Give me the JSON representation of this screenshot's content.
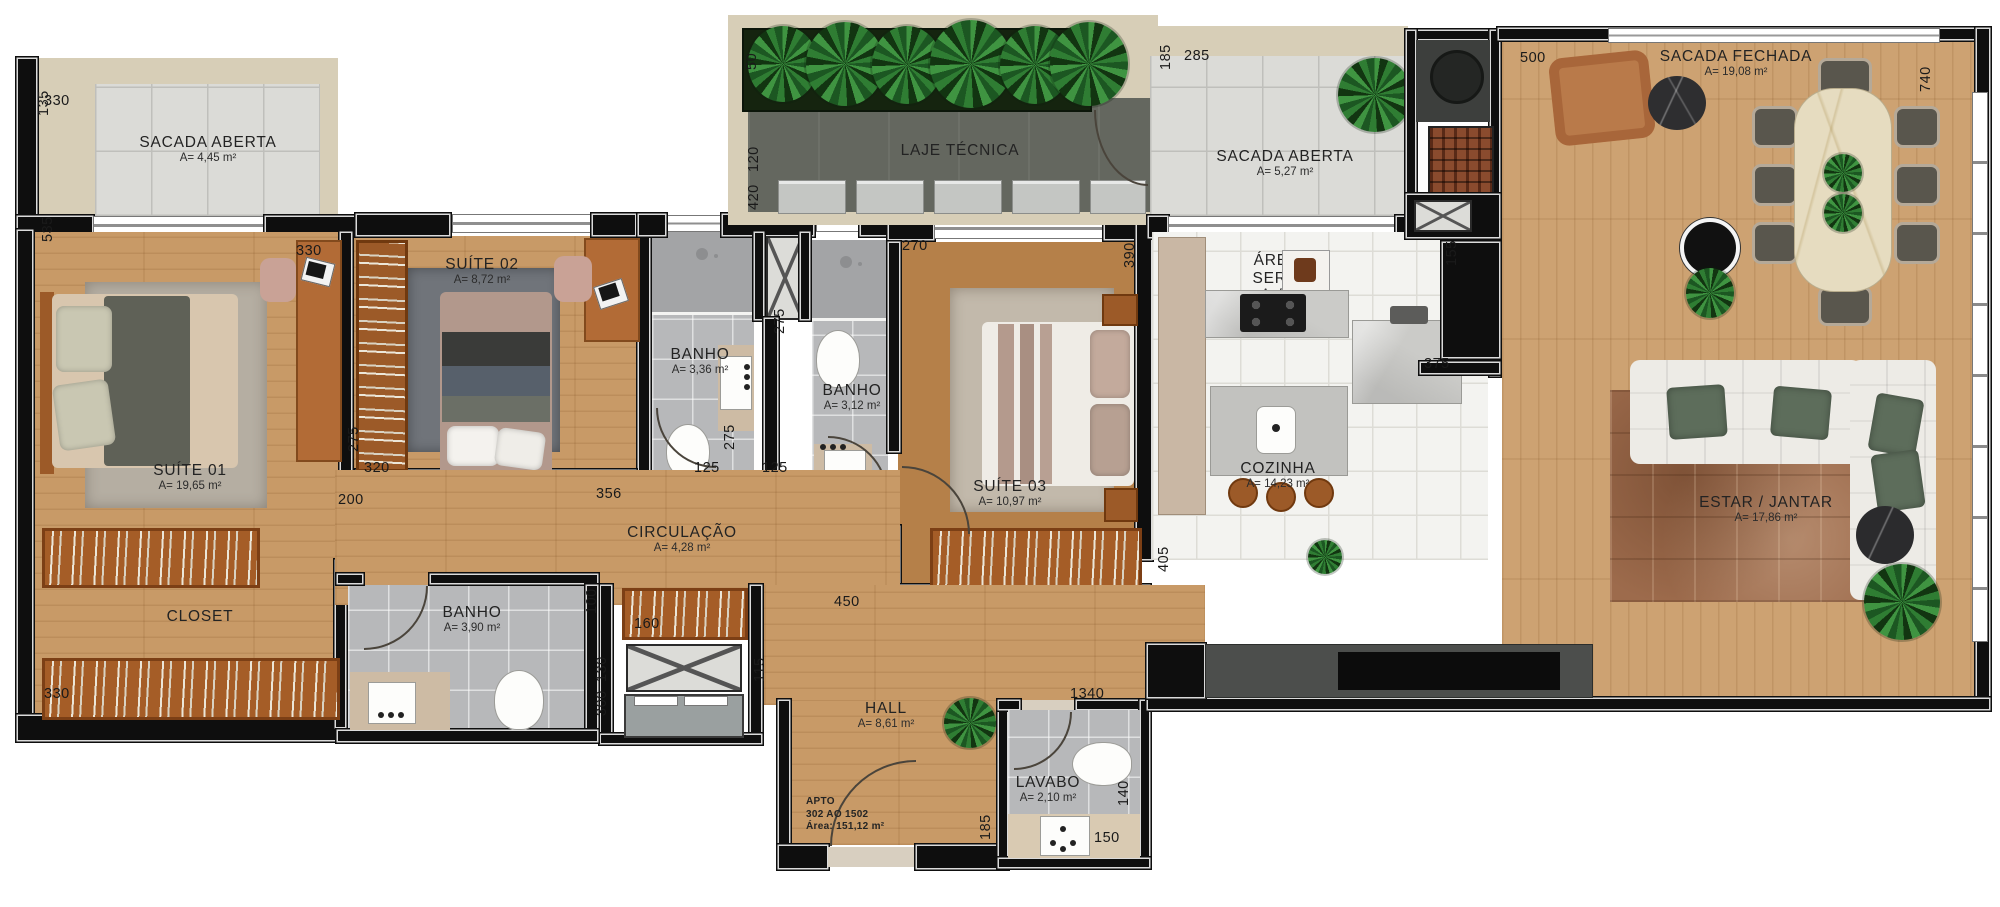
{
  "plan": {
    "rooms": [
      {
        "name": "SACADA ABERTA",
        "area": "A= 4,45 m²"
      },
      {
        "name": "SUÍTE 01",
        "area": "A= 19,65 m²"
      },
      {
        "name": "CLOSET",
        "area": ""
      },
      {
        "name": "SUÍTE 02",
        "area": "A= 8,72 m²"
      },
      {
        "name": "BANHO",
        "area": "A= 3,36 m²"
      },
      {
        "name": "BANHO",
        "area": "A= 3,12 m²"
      },
      {
        "name": "BANHO",
        "area": "A= 3,90 m²"
      },
      {
        "name": "LAJE TÉCNICA",
        "area": ""
      },
      {
        "name": "SACADA ABERTA",
        "area": "A= 5,27 m²"
      },
      {
        "name": "ÁREA DE SERVIÇO",
        "area": "A= 5,04 m²"
      },
      {
        "name": "COZINHA",
        "area": "A= 14,23 m²"
      },
      {
        "name": "SUÍTE 03",
        "area": "A= 10,97 m²"
      },
      {
        "name": "CIRCULAÇÃO",
        "area": "A= 4,28 m²"
      },
      {
        "name": "HALL",
        "area": "A= 8,61 m²"
      },
      {
        "name": "LAVABO",
        "area": "A= 2,10 m²"
      },
      {
        "name": "SACADA FECHADA",
        "area": "A= 19,08 m²"
      },
      {
        "name": "ESTAR / JANTAR",
        "area": "A= 17,86 m²"
      }
    ],
    "stamp": {
      "line1": "APTO",
      "line2": "302 AO 1502",
      "line3": "Área: 151,12 m²"
    },
    "dimensions": [
      "330",
      "135",
      "535",
      "330",
      "275",
      "320",
      "200",
      "330",
      "50",
      "120",
      "420",
      "185",
      "285",
      "270",
      "390",
      "155",
      "375",
      "500",
      "740",
      "405",
      "450",
      "275",
      "125",
      "275",
      "125",
      "356",
      "100",
      "160",
      "130",
      "300",
      "115",
      "1340",
      "185",
      "140",
      "150"
    ],
    "colors": {
      "wall": "#0e0e0e",
      "wood": "#c89a67",
      "tile_balcony": "#dbdbd7",
      "tile_bath": "#b7b8ba",
      "tile_kitchen": "#f3f3f0",
      "laje": "#64675f",
      "beige": "#d7ceb7",
      "plant_green": "#2f7d33",
      "rug_living": "#9d6b4c",
      "sofa": "#edebe6",
      "dining_marble": "#e6dcc0"
    }
  }
}
